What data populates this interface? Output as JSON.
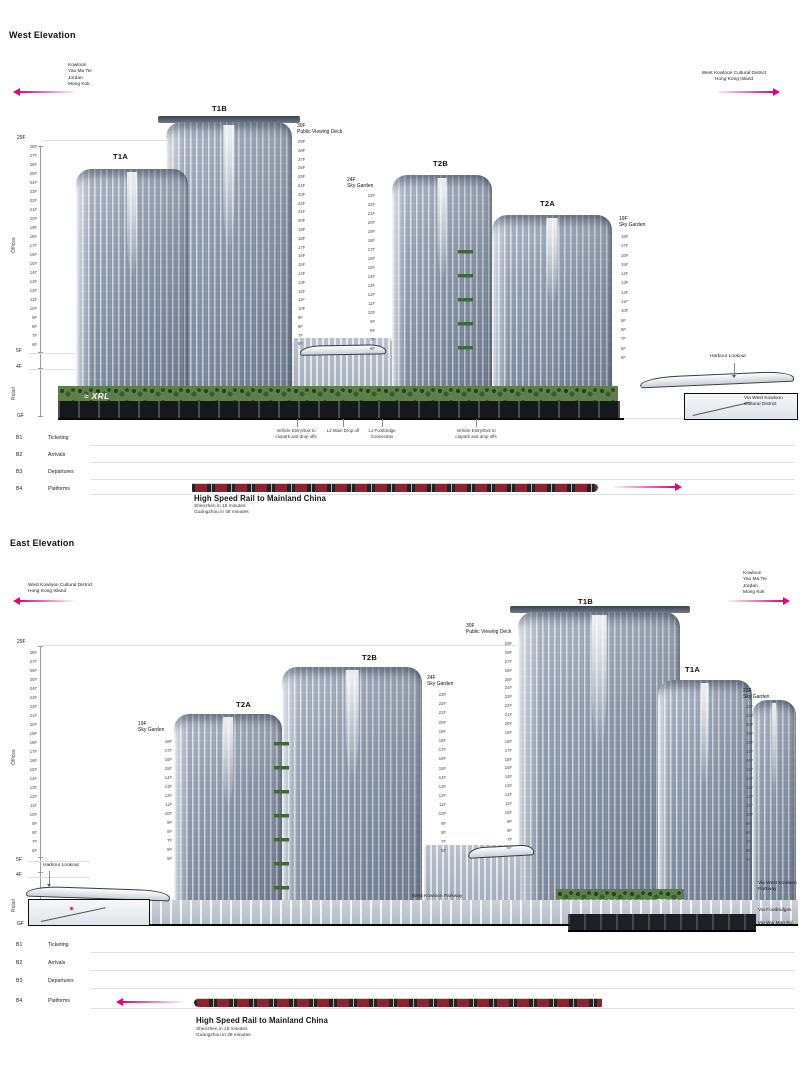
{
  "colors": {
    "accent": "#e5007d",
    "ground": "#0a0a0a"
  },
  "floors": {
    "f28_6": [
      "28F",
      "27F",
      "26F",
      "25F",
      "24F",
      "23F",
      "22F",
      "21F",
      "20F",
      "19F",
      "18F",
      "17F",
      "16F",
      "15F",
      "14F",
      "13F",
      "12F",
      "11F",
      "10F",
      "9F",
      "8F",
      "7F",
      "6F"
    ],
    "f29_6": [
      "29F",
      "28F",
      "27F",
      "26F",
      "25F",
      "24F",
      "23F",
      "22F",
      "21F",
      "20F",
      "19F",
      "18F",
      "17F",
      "16F",
      "15F",
      "14F",
      "13F",
      "12F",
      "11F",
      "10F",
      "9F",
      "8F",
      "7F",
      "6F"
    ],
    "f23_6": [
      "23F",
      "22F",
      "21F",
      "20F",
      "19F",
      "18F",
      "17F",
      "16F",
      "15F",
      "14F",
      "13F",
      "12F",
      "11F",
      "10F",
      "9F",
      "8F",
      "7F",
      "6F"
    ],
    "f18_5": [
      "18F",
      "17F",
      "16F",
      "15F",
      "14F",
      "13F",
      "12F",
      "11F",
      "10F",
      "9F",
      "8F",
      "7F",
      "6F",
      "5F"
    ],
    "f22_5": [
      "22F",
      "21F",
      "20F",
      "19F",
      "18F",
      "17F",
      "16F",
      "15F",
      "14F",
      "13F",
      "12F",
      "11F",
      "10F",
      "9F",
      "8F",
      "7F",
      "6F",
      "5F"
    ]
  },
  "west": {
    "title": "West Elevation",
    "dir_left": [
      "Kowloon",
      "Yau Ma Tei",
      "Jordan",
      "Mong Kok"
    ],
    "dir_right": [
      "West Kowloon Cultural District",
      "Hong Kong Island"
    ],
    "axis": {
      "top": "29F",
      "f5": "5F",
      "f4": "4F",
      "gf": "GF",
      "offices": "Offices",
      "retail": "Retail"
    },
    "towers": {
      "t1a": "T1A",
      "t1b": "T1B",
      "t2a": "T2A",
      "t2b": "T2B"
    },
    "deck": [
      "30F",
      "Public Viewing Deck"
    ],
    "sky24": [
      "24F",
      "Sky Garden"
    ],
    "sky19": [
      "19F",
      "Sky Garden"
    ],
    "harbour_lookout": "Harbour Lookout",
    "via_wkcd": [
      "Via West Kowloon",
      "Cultural District"
    ],
    "vehicle1": [
      "Vehicle Entry/Exit to",
      "carpark and drop offs"
    ],
    "dropoff": [
      "L2 Main Drop off"
    ],
    "footbridge": [
      "L1 Footbridge",
      "Connection"
    ],
    "vehicle2": [
      "Vehicle Entry/Exit to",
      "carpark and drop offs"
    ],
    "xrl": "XRL",
    "basement": [
      {
        "code": "B1",
        "label": "Ticketing"
      },
      {
        "code": "B2",
        "label": "Arrivals"
      },
      {
        "code": "B3",
        "label": "Departures"
      },
      {
        "code": "B4",
        "label": "Platforms"
      }
    ],
    "hsr": {
      "title": "High Speed Rail to Mainland China",
      "subs": [
        "Shenzhen in 15 minutes",
        "Guangzhou in 48 minutes"
      ]
    }
  },
  "east": {
    "title": "East Elevation",
    "dir_left": [
      "West Kowloon Cultural District",
      "Hong Kong Island"
    ],
    "dir_right": [
      "Kowloon",
      "Yau Ma Tei",
      "Jordan",
      "Mong Kok"
    ],
    "axis": {
      "top": "29F",
      "f5": "5F",
      "f4": "4F",
      "gf": "GF",
      "offices": "Offices",
      "retail": "Retail"
    },
    "towers": {
      "t1a": "T1A",
      "t1b": "T1B",
      "t2a": "T2A",
      "t2b": "T2B"
    },
    "deck": [
      "30F",
      "Public Viewing Deck"
    ],
    "sky24": [
      "24F",
      "Sky Garden"
    ],
    "sky19": [
      "19F",
      "Sky Garden"
    ],
    "sky23": [
      "23F",
      "Sky Garden"
    ],
    "harbour_lookout": "Harbour Lookout",
    "parkway": "West Kowloon Parkway",
    "via_parkway": [
      "Via West Kowloon",
      "Parkway"
    ],
    "via_footbridges": "Via Footbridges",
    "via_wui_man": "Via Wui Man Rd",
    "basement": [
      {
        "code": "B1",
        "label": "Ticketing"
      },
      {
        "code": "B2",
        "label": "Arrivals"
      },
      {
        "code": "B3",
        "label": "Departures"
      },
      {
        "code": "B4",
        "label": "Platforms"
      }
    ],
    "hsr": {
      "title": "High Speed Rail to Mainland China",
      "subs": [
        "Shenzhen in 15 minutes",
        "Guangzhou in 48 minutes"
      ]
    }
  }
}
